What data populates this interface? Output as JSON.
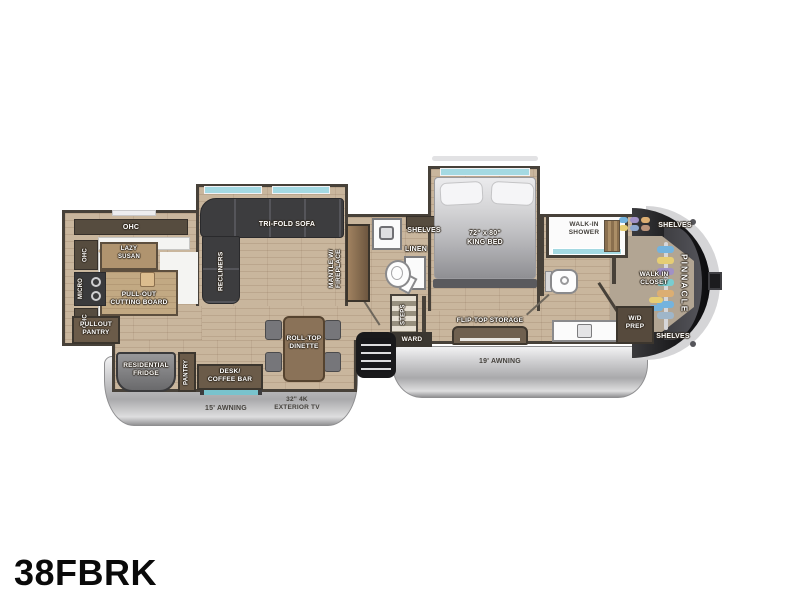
{
  "model": "38FBRK",
  "brand": "PINNACLE",
  "kitchen": {
    "ohc_top": "OHC",
    "ohc_upper": "OHC",
    "micro": "MICRO",
    "ohc_lower": "OHC",
    "lazy_susan": "LAZY\nSUSAN",
    "cutting_board": "PULL-OUT\nCUTTING BOARD",
    "pullout_pantry": "PULLOUT\nPANTRY"
  },
  "living": {
    "sofa": "TRI-FOLD SOFA",
    "recliners": "RECLINERS",
    "fireplace": "MANTLE W/\nFIREPLACE"
  },
  "mid_bath": {
    "shelves": "SHELVES",
    "linen": "LINEN",
    "steps": "STEPS",
    "ward": "WARD"
  },
  "bedroom": {
    "bed": "72\" x 80\"\nKING BED",
    "flip_top": "FLIP-TOP STORAGE"
  },
  "rear_bath": {
    "shower": "WALK-IN\nSHOWER",
    "wd_prep": "W/D\nPREP"
  },
  "closet": {
    "name": "WALK IN\nCLOSET",
    "shelves_top": "SHELVES",
    "shelves_bottom": "SHELVES"
  },
  "dinette_area": {
    "dinette": "ROLL-TOP\nDINETTE",
    "desk": "DESK/\nCOFFEE BAR",
    "pantry": "PANTRY",
    "fridge": "RESIDENTIAL\nFRIDGE"
  },
  "exterior": {
    "awning_rear": "15' AWNING",
    "awning_main": "19' AWNING",
    "tv": "32\" 4K\nEXTERIOR TV"
  },
  "colors": {
    "floor": "#c9b69d",
    "wall": "#474139",
    "cabinet": "#6b5b49",
    "sofa": "#3d3d3f",
    "window_glass": "#a4d9e2",
    "front_cap": "#17171a",
    "awning_skirt": "#c4c4c6"
  }
}
